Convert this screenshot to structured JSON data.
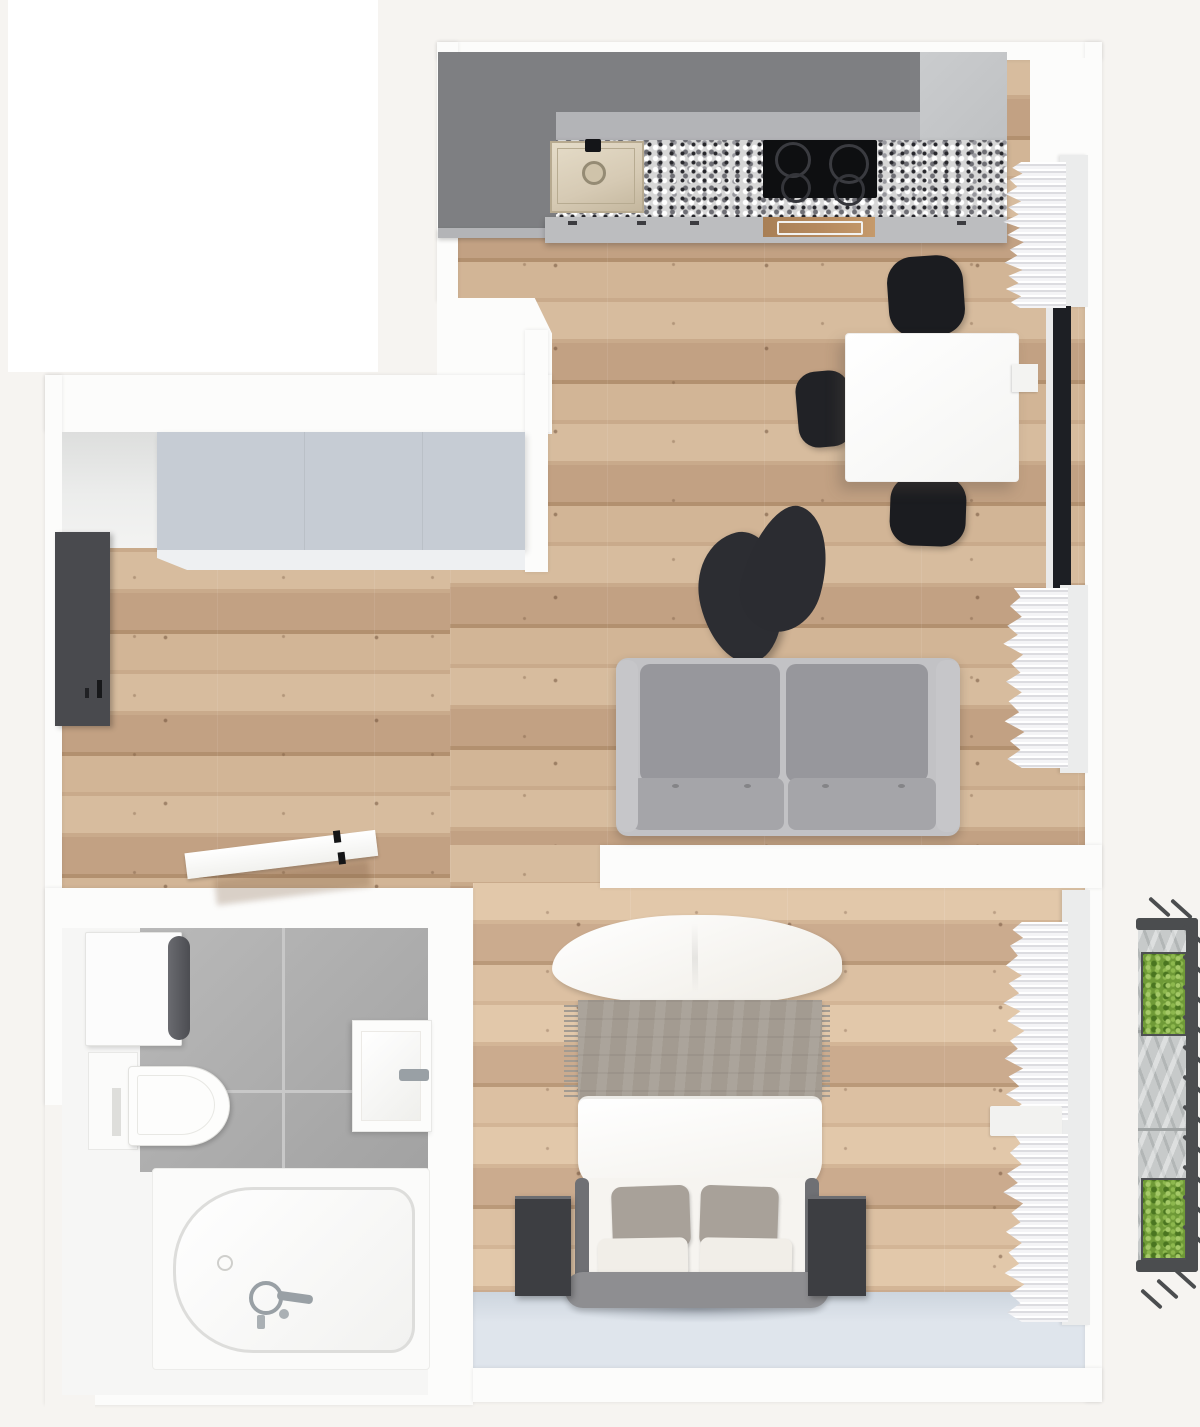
{
  "scene": {
    "type": "3d-floor-plan-top-view",
    "description": "top-down 3D render of a studio apartment",
    "visible_text": "none"
  },
  "palette": {
    "bg": "#f6f4f1",
    "white": "#ffffff",
    "wall": "#fcfcfb",
    "wood_base": "#c9aa8b",
    "wood_light": "#d7bc9e",
    "wood_mid": "#c2a183",
    "wood_dark": "#b2906f",
    "cab_dark": "#7e7f82",
    "cab_mid": "#b3b4b7",
    "cab_front": "#bcbdbf",
    "cab_tall": "#caccce",
    "steel": "#d6cab4",
    "cooktop": "#0e0f11",
    "oven": "#b5895e",
    "wardrobe_top": "#c6ccd4",
    "door_dark": "#494a4e",
    "sofa_shell": "#c2c2c5",
    "sofa_back": "#97979c",
    "sofa_seat": "#a5a5a9",
    "chair_black": "#1b1c20",
    "armchair": "#2b2c31",
    "table_white": "#fefefe",
    "tile_light": "#b9b9b9",
    "tile_dark": "#a2a2a2",
    "grout": "#c8c8c8",
    "chrome": "#99a0a5",
    "blanket": "#a39b91",
    "pillow_gray": "#a8a199",
    "cushion": "#f1eee8",
    "frame_gray": "#8e8e91",
    "rail_gray": "#6f7074",
    "nightstand": "#3d3e42",
    "pale_floor": "#dfe5ec",
    "curtain_shadow": "#dcdce0",
    "pelmet": "#ebecec",
    "glass": "#1d1f24",
    "stone": "#c7caca",
    "rail": "#4b4d4f",
    "plant": "#6f9a37",
    "plant_dark": "#4a7520",
    "plant_light": "#a5c968"
  },
  "rooms": {
    "kitchen_living": {
      "furniture": [
        {
          "item": "kitchen-upper-cabinets",
          "count": 1
        },
        {
          "item": "kitchen-tall-cabinet",
          "count": 1
        },
        {
          "item": "granite-countertop",
          "count": 1
        },
        {
          "item": "kitchen-sink",
          "count": 1
        },
        {
          "item": "cooktop-burner",
          "count": 4
        },
        {
          "item": "oven",
          "count": 1
        },
        {
          "item": "dining-table",
          "count": 1
        },
        {
          "item": "dining-chair",
          "count": 3
        },
        {
          "item": "lounge-chair",
          "count": 1
        },
        {
          "item": "two-seat-sofa",
          "count": 1
        },
        {
          "item": "window",
          "count": 1
        },
        {
          "item": "curtain",
          "count": 2
        }
      ]
    },
    "hallway": {
      "furniture": [
        {
          "item": "wardrobe",
          "count": 1
        },
        {
          "item": "entry-door-panel",
          "count": 1
        },
        {
          "item": "open-bathroom-door",
          "count": 1
        }
      ]
    },
    "bathroom": {
      "furniture": [
        {
          "item": "washing-machine",
          "count": 1
        },
        {
          "item": "toilet",
          "count": 1
        },
        {
          "item": "washbasin",
          "count": 1
        },
        {
          "item": "bathtub",
          "count": 1
        }
      ]
    },
    "bedroom": {
      "furniture": [
        {
          "item": "double-bed",
          "count": 1
        },
        {
          "item": "large-pillow",
          "count": 1
        },
        {
          "item": "gray-pillow",
          "count": 2
        },
        {
          "item": "white-cushion",
          "count": 2
        },
        {
          "item": "nightstand",
          "count": 2
        },
        {
          "item": "curtain",
          "count": 2
        }
      ]
    },
    "balcony": {
      "furniture": [
        {
          "item": "planter-box",
          "count": 2
        },
        {
          "item": "railing",
          "count": 1
        }
      ]
    }
  }
}
